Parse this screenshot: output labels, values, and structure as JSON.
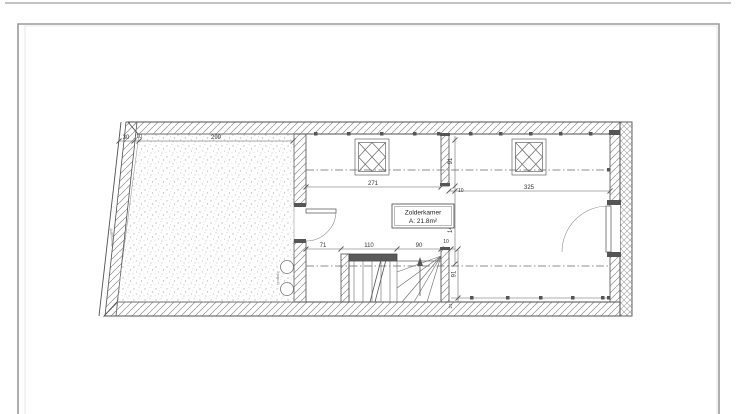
{
  "drawing": {
    "room": {
      "name": "Zolderkamer",
      "area": "A: 21.8m²"
    },
    "labels": {
      "boundary": "Buurpand",
      "vent": "ventilatie"
    },
    "dims": {
      "top_left": "30",
      "top_small": "10",
      "top_width": "299",
      "room1_width": "271",
      "room2_width": "325",
      "stub_height": "91",
      "stub_offset": "10",
      "mid_height": "146",
      "stair_left": "71",
      "stair_width": "110",
      "stair_right": "90",
      "stair_small": "10",
      "knee_height": "91",
      "knee_small": "21"
    },
    "colors": {
      "line": "#4f4f4f",
      "hatch": "#8f8f8f",
      "dim_text": "#333333",
      "stipple": "#bdbdbd",
      "frame": "#9a9a9a"
    }
  }
}
